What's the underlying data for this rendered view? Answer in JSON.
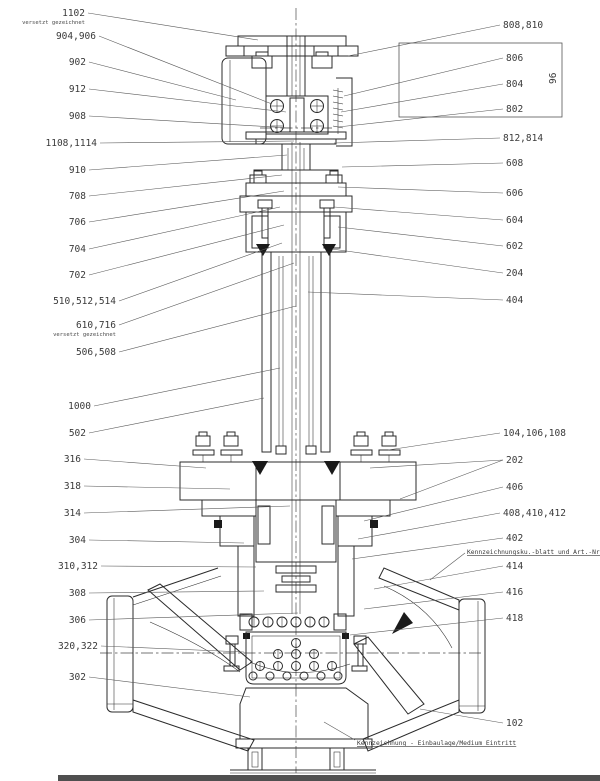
{
  "annotations": {
    "box_side_label": "96",
    "offset_note": "versetzt gezeichnet"
  },
  "colors": {
    "line": "#2b2b2b",
    "background": "#ffffff",
    "label": "#3a3a3a",
    "sheet_edge": "#4f4f4f"
  },
  "callouts": {
    "items": [
      {
        "text": "1102",
        "x": 85,
        "y": 13,
        "anchor": "end",
        "sub": "versetzt gezeichnet",
        "leaders": [
          [
            88,
            13,
            258,
            40
          ]
        ]
      },
      {
        "text": "904,906",
        "x": 96,
        "y": 36,
        "anchor": "end",
        "leaders": [
          [
            99,
            36,
            272,
            104
          ]
        ]
      },
      {
        "text": "902",
        "x": 86,
        "y": 62,
        "anchor": "end",
        "leaders": [
          [
            89,
            62,
            236,
            100
          ]
        ]
      },
      {
        "text": "912",
        "x": 86,
        "y": 89,
        "anchor": "end",
        "leaders": [
          [
            89,
            89,
            286,
            112
          ]
        ]
      },
      {
        "text": "908",
        "x": 86,
        "y": 116,
        "anchor": "end",
        "leaders": [
          [
            89,
            116,
            290,
            128
          ]
        ]
      },
      {
        "text": "1108,1114",
        "x": 97,
        "y": 143,
        "anchor": "end",
        "leaders": [
          [
            100,
            143,
            294,
            141
          ]
        ]
      },
      {
        "text": "910",
        "x": 86,
        "y": 170,
        "anchor": "end",
        "leaders": [
          [
            89,
            170,
            287,
            155
          ]
        ]
      },
      {
        "text": "708",
        "x": 86,
        "y": 196,
        "anchor": "end",
        "leaders": [
          [
            89,
            196,
            282,
            175
          ]
        ]
      },
      {
        "text": "706",
        "x": 86,
        "y": 222,
        "anchor": "end",
        "leaders": [
          [
            89,
            222,
            284,
            191
          ]
        ]
      },
      {
        "text": "704",
        "x": 86,
        "y": 249,
        "anchor": "end",
        "leaders": [
          [
            89,
            249,
            280,
            207
          ]
        ]
      },
      {
        "text": "702",
        "x": 86,
        "y": 275,
        "anchor": "end",
        "leaders": [
          [
            89,
            275,
            284,
            225
          ]
        ]
      },
      {
        "text": "510,512,514",
        "x": 116,
        "y": 301,
        "anchor": "end",
        "leaders": [
          [
            119,
            301,
            282,
            243
          ]
        ]
      },
      {
        "text": "610,716",
        "x": 116,
        "y": 325,
        "anchor": "end",
        "sub": "versetzt gezeichnet",
        "leaders": [
          [
            119,
            325,
            294,
            263
          ]
        ]
      },
      {
        "text": "506,508",
        "x": 116,
        "y": 352,
        "anchor": "end",
        "leaders": [
          [
            119,
            352,
            296,
            306
          ]
        ]
      },
      {
        "text": "1000",
        "x": 91,
        "y": 406,
        "anchor": "end",
        "leaders": [
          [
            94,
            406,
            280,
            368
          ]
        ]
      },
      {
        "text": "502",
        "x": 86,
        "y": 433,
        "anchor": "end",
        "leaders": [
          [
            89,
            433,
            264,
            398
          ]
        ]
      },
      {
        "text": "316",
        "x": 81,
        "y": 459,
        "anchor": "end",
        "leaders": [
          [
            84,
            459,
            206,
            468
          ]
        ]
      },
      {
        "text": "318",
        "x": 81,
        "y": 486,
        "anchor": "end",
        "leaders": [
          [
            84,
            486,
            230,
            489
          ]
        ]
      },
      {
        "text": "314",
        "x": 81,
        "y": 513,
        "anchor": "end",
        "leaders": [
          [
            84,
            513,
            290,
            506
          ]
        ]
      },
      {
        "text": "304",
        "x": 86,
        "y": 540,
        "anchor": "end",
        "leaders": [
          [
            89,
            540,
            244,
            543
          ]
        ]
      },
      {
        "text": "310,312",
        "x": 98,
        "y": 566,
        "anchor": "end",
        "leaders": [
          [
            101,
            566,
            256,
            567
          ]
        ]
      },
      {
        "text": "308",
        "x": 86,
        "y": 593,
        "anchor": "end",
        "leaders": [
          [
            89,
            593,
            264,
            591
          ]
        ]
      },
      {
        "text": "306",
        "x": 86,
        "y": 620,
        "anchor": "end",
        "leaders": [
          [
            89,
            620,
            298,
            613
          ]
        ]
      },
      {
        "text": "320,322",
        "x": 98,
        "y": 646,
        "anchor": "end",
        "leaders": [
          [
            101,
            646,
            244,
            652
          ]
        ]
      },
      {
        "text": "302",
        "x": 86,
        "y": 677,
        "anchor": "end",
        "leaders": [
          [
            89,
            677,
            250,
            697
          ]
        ]
      },
      {
        "text": "808,810",
        "x": 503,
        "y": 25,
        "anchor": "start",
        "leaders": [
          [
            500,
            25,
            348,
            56
          ]
        ]
      },
      {
        "text": "806",
        "x": 506,
        "y": 58,
        "anchor": "start",
        "leaders": [
          [
            503,
            58,
            344,
            96
          ]
        ]
      },
      {
        "text": "804",
        "x": 506,
        "y": 84,
        "anchor": "start",
        "leaders": [
          [
            503,
            84,
            341,
            112
          ]
        ]
      },
      {
        "text": "802",
        "x": 506,
        "y": 109,
        "anchor": "start",
        "leaders": [
          [
            503,
            109,
            338,
            127
          ]
        ]
      },
      {
        "text": "812,814",
        "x": 503,
        "y": 138,
        "anchor": "start",
        "leaders": [
          [
            500,
            138,
            334,
            143
          ]
        ]
      },
      {
        "text": "608",
        "x": 506,
        "y": 163,
        "anchor": "start",
        "leaders": [
          [
            503,
            163,
            342,
            167
          ]
        ]
      },
      {
        "text": "606",
        "x": 506,
        "y": 193,
        "anchor": "start",
        "leaders": [
          [
            503,
            193,
            338,
            187
          ]
        ]
      },
      {
        "text": "604",
        "x": 506,
        "y": 220,
        "anchor": "start",
        "leaders": [
          [
            503,
            220,
            334,
            207
          ]
        ]
      },
      {
        "text": "602",
        "x": 506,
        "y": 246,
        "anchor": "start",
        "leaders": [
          [
            503,
            246,
            338,
            227
          ]
        ]
      },
      {
        "text": "204",
        "x": 506,
        "y": 273,
        "anchor": "start",
        "leaders": [
          [
            503,
            273,
            332,
            249
          ]
        ]
      },
      {
        "text": "404",
        "x": 506,
        "y": 300,
        "anchor": "start",
        "leaders": [
          [
            503,
            300,
            308,
            292
          ]
        ]
      },
      {
        "text": "104,106,108",
        "x": 503,
        "y": 433,
        "anchor": "start",
        "leaders": [
          [
            500,
            433,
            388,
            450
          ]
        ]
      },
      {
        "text": "202",
        "x": 506,
        "y": 460,
        "anchor": "start",
        "leaders": [
          [
            503,
            460,
            370,
            468
          ],
          [
            503,
            460,
            400,
            499
          ]
        ]
      },
      {
        "text": "406",
        "x": 506,
        "y": 487,
        "anchor": "start",
        "leaders": [
          [
            503,
            487,
            364,
            521
          ]
        ]
      },
      {
        "text": "408,410,412",
        "x": 503,
        "y": 513,
        "anchor": "start",
        "leaders": [
          [
            500,
            513,
            358,
            539
          ]
        ]
      },
      {
        "text": "402",
        "x": 506,
        "y": 538,
        "anchor": "start",
        "leaders": [
          [
            503,
            538,
            352,
            559
          ]
        ]
      },
      {
        "text": "Kennzeichnungsku.-blatt und Art.-Nr.",
        "x": 467,
        "y": 551,
        "anchor": "start",
        "small": true,
        "underline": true,
        "leaders": [
          [
            465,
            553,
            430,
            580
          ]
        ]
      },
      {
        "text": "414",
        "x": 506,
        "y": 566,
        "anchor": "start",
        "leaders": [
          [
            503,
            566,
            374,
            589
          ]
        ]
      },
      {
        "text": "416",
        "x": 506,
        "y": 592,
        "anchor": "start",
        "leaders": [
          [
            503,
            592,
            364,
            609
          ]
        ]
      },
      {
        "text": "418",
        "x": 506,
        "y": 618,
        "anchor": "start",
        "leaders": [
          [
            503,
            618,
            350,
            635
          ]
        ]
      },
      {
        "text": "102",
        "x": 506,
        "y": 723,
        "anchor": "start",
        "leaders": [
          [
            503,
            723,
            420,
            709
          ]
        ]
      },
      {
        "text": "Kennzeichnung - Einbaulage/Medium Eintritt",
        "x": 357,
        "y": 742,
        "anchor": "start",
        "small": true,
        "underline": true,
        "leaders": [
          [
            355,
            740,
            324,
            722
          ]
        ]
      }
    ]
  }
}
